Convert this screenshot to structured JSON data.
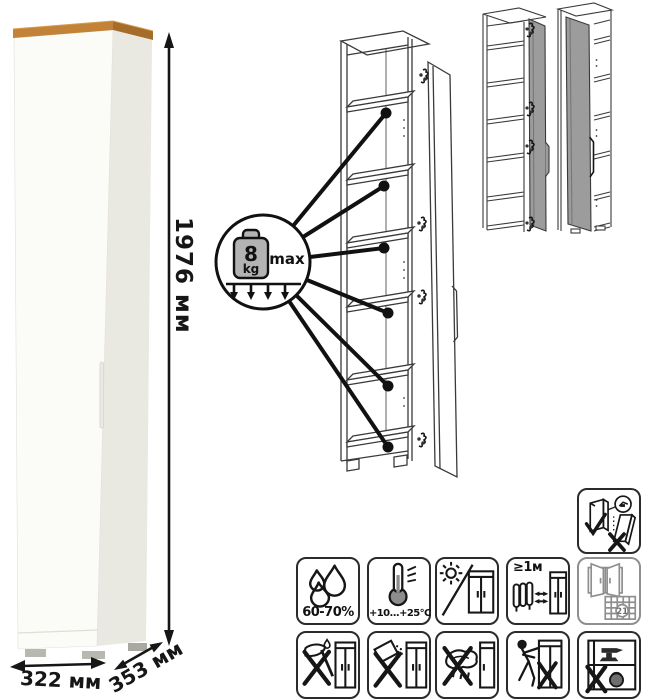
{
  "dimensions": {
    "height": "1976 мм",
    "width": "322 мм",
    "depth": "353 мм"
  },
  "load_limit": {
    "value": "8",
    "unit": "kg",
    "qualifier": "max"
  },
  "care_icons": {
    "humidity": "60-70%",
    "temperature": "+10...+25°C",
    "heat_distance": "≥1м",
    "ventilation_day": "21"
  },
  "colors": {
    "wood_top": "#c28238",
    "cabinet_front": "#fbfbf8",
    "cabinet_side": "#e9e8e1",
    "line_art": "#3a3a3a",
    "door_gray": "#9c9c9c",
    "callout_black": "#111111"
  }
}
